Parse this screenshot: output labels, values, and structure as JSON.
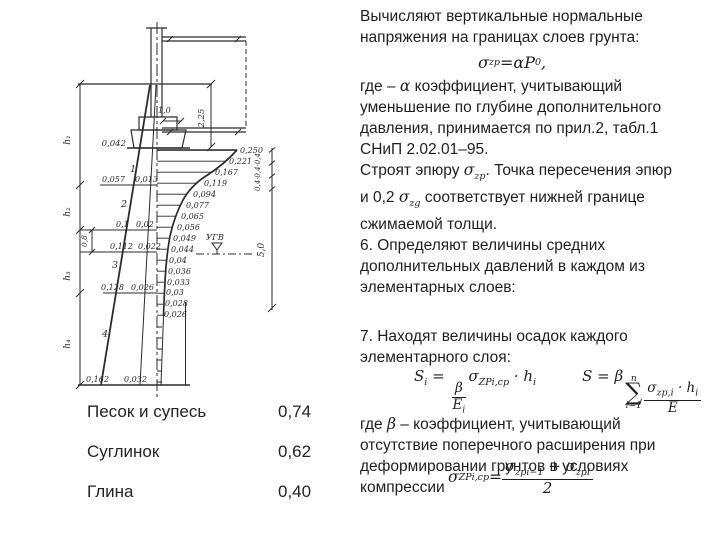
{
  "slide": {
    "text": {
      "p1": [
        "Вычисляют вертикальные нормальные",
        "напряжения на границах слоев грунта:"
      ],
      "p2_prefix": "где – ",
      "p2_alpha": "α",
      "p2_rest": " коэффициент, учитывающий",
      "p2": [
        "уменьшение по глубине дополнительного",
        "давления, принимается по прил.2, табл.1",
        "СНиП 2.02.01–95."
      ],
      "p3_a": "Строят эпюру ",
      "p3_sigma": "σ",
      "p3_sigma_sub": "zp",
      "p3_b": ". Точка пересечения эпюр",
      "p3_c": "и 0,2 ",
      "p3_sigma2": "σ",
      "p3_sigma2_sub": "zg",
      "p3_d": " соответствует нижней границе",
      "p3_e": "сжимаемой толщи.",
      "p4": [
        "6. Определяют величины средних",
        "дополнительных давлений в каждом из",
        "элементарных слоев:"
      ],
      "p5": [
        "7. Находят величины осадок каждого",
        "элементарного слоя:"
      ],
      "p6_prefix": "где ",
      "p6_beta": "β",
      "p6_rest": " – коэффициент, учитывающий",
      "p6": [
        "отсутствие поперечного расширения при",
        "деформировании грунтов в условиях",
        "компрессии"
      ]
    },
    "formulas": {
      "f1": {
        "sym": "σ",
        "sub": "zp",
        "eq": " = ",
        "alpha": "α",
        "P": "P",
        "Psub": "0",
        "tail": ","
      },
      "f2": {
        "S": "S",
        "Ssub": "i",
        "eq": " = ",
        "num": "β",
        "den": "E",
        "densub": "i",
        "sigma": "σ",
        "sigmasub": "ZPi,cp",
        "dot": " · ",
        "h": "h",
        "hsub": "i"
      },
      "f3": {
        "S": "S",
        "eq": " = ",
        "beta": "β",
        "sum": "∑",
        "top": "n",
        "bottom": "i=1",
        "nsigma": "σ",
        "nsub": "zp,i",
        "dot": " · ",
        "nh": "h",
        "nhsub": "i",
        "den": "E"
      },
      "f4": {
        "sym": "σ",
        "sub": "ZPi,cp",
        "eq": " = ",
        "a": "σ",
        "asub": "zpi−1",
        "plus": " + ",
        "b": "σ",
        "bsub": "zpi",
        "den": "2"
      }
    },
    "table": {
      "rows": [
        {
          "label": "Песок и супесь",
          "value": "0,74"
        },
        {
          "label": "Суглинок",
          "value": "0,62"
        },
        {
          "label": "Глина",
          "value": "0,40"
        }
      ]
    },
    "diagram": {
      "epure_values": [
        "0,250",
        "0,221",
        "0,167",
        "0,119",
        "0,094",
        "0,077",
        "0,065",
        "0,056",
        "0,049",
        "0,044",
        "0,04",
        "0,036",
        "0,033",
        "0,03",
        "0,028",
        "0,026"
      ],
      "left_values": [
        {
          "a": "0,057",
          "b": "0,013"
        },
        {
          "a": "0,1",
          "b": "0,02"
        },
        {
          "a": "0,112",
          "b": "0,022"
        },
        {
          "a": "0,128",
          "b": "0,026"
        },
        {
          "a": "0,162",
          "b": "0,032"
        }
      ],
      "layer_numbers": [
        "1",
        "2",
        "3",
        "4"
      ],
      "h_labels": [
        "h₁",
        "h₂",
        "h₃",
        "h₄"
      ],
      "dim_10": "1,0",
      "dim_225": "2,25",
      "dim_042": "0,042",
      "dim_08": "0,8",
      "dim_04": "0,4·0,4·0,4",
      "dim_50": "5,0",
      "ugv": "УГВ"
    }
  }
}
